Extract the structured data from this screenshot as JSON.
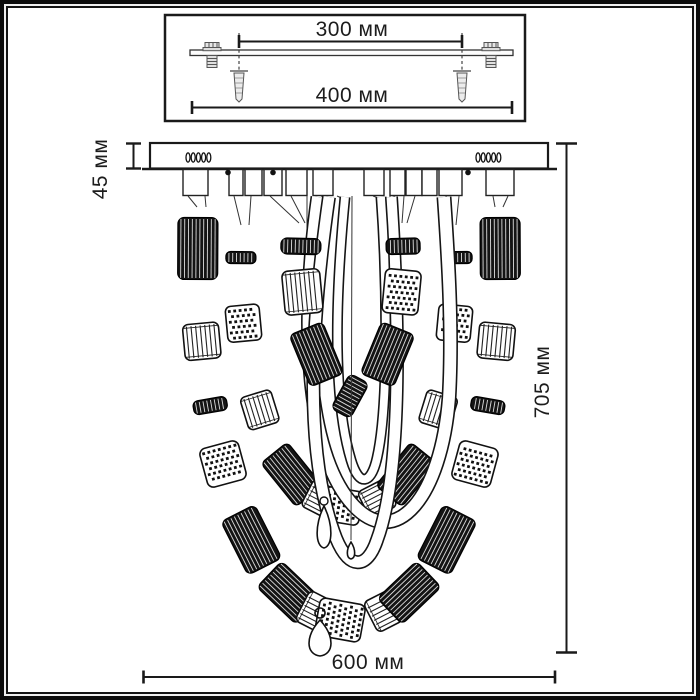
{
  "mounting_detail": {
    "hole_spacing": "300 мм",
    "bracket_length": "400 мм"
  },
  "fixture": {
    "canopy_height": "45 мм",
    "overall_height": "705 мм",
    "overall_width": "600 мм"
  },
  "colors": {
    "ink": "#1a1a1a",
    "paper": "#ffffff",
    "frame": "#0c0c0c"
  }
}
